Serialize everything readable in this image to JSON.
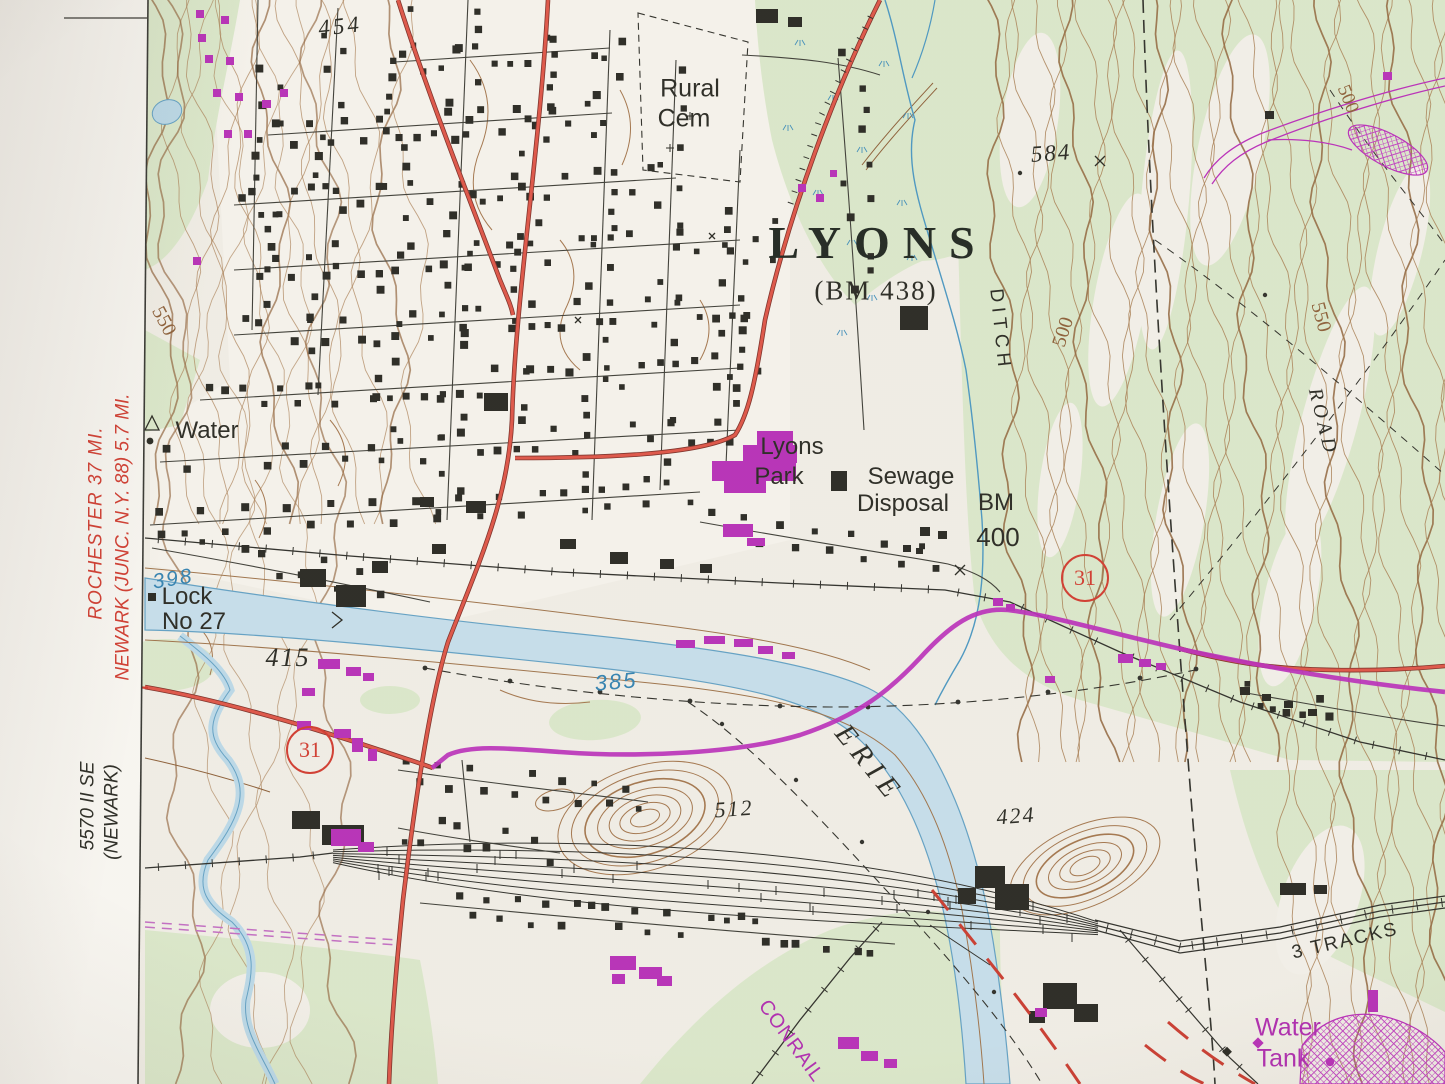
{
  "place_labels": {
    "town_name": "LYONS",
    "town_benchmark": "(BM 438)",
    "rural_cemetery_line1": "Rural",
    "rural_cemetery_line2": "Cem",
    "lyons_park_line1": "Lyons",
    "lyons_park_line2": "Park",
    "sewage_disposal_line1": "Sewage",
    "sewage_disposal_line2": "Disposal",
    "benchmark_bm": "BM",
    "benchmark_value": "400",
    "lock_line1": "Lock",
    "lock_line2": "No 27",
    "water_supply": "Water",
    "ditch": "DITCH",
    "road": "ROAD",
    "erie_canal": "ERIE",
    "conrail": "CONRAIL",
    "three_tracks": "3 TRACKS",
    "water_tank_line1": "Water",
    "water_tank_line2": "Tank"
  },
  "elevations": {
    "spot_454": "454",
    "spot_584": "584",
    "spot_512": "512",
    "spot_424": "424",
    "spot_415": "415",
    "water_surface_398": "398",
    "water_surface_385": "385",
    "contour_550_west": "550",
    "contour_550_east": "550",
    "contour_500_center": "500",
    "contour_500_northeast": "500"
  },
  "route_shields": {
    "route_31_west": "31",
    "route_31_east": "31"
  },
  "margin_notes": {
    "destination_line1": "ROCHESTER 37 MI.",
    "destination_line2": "NEWARK (JUNC. N.Y. 88) 5.7 MI.",
    "adjoining_quad_line1": "5570 II SE",
    "adjoining_quad_line2": "(NEWARK)"
  },
  "map_colors": {
    "paper": "#efece4",
    "woodland_green": "#d9e6c8",
    "contour_brown": "#a57a50",
    "water_blue_fill": "#c4dce9",
    "water_blue_line": "#5c9dc2",
    "road_red": "#d84b3d",
    "revision_magenta": "#b52cb5",
    "ink_black": "#26261f"
  }
}
